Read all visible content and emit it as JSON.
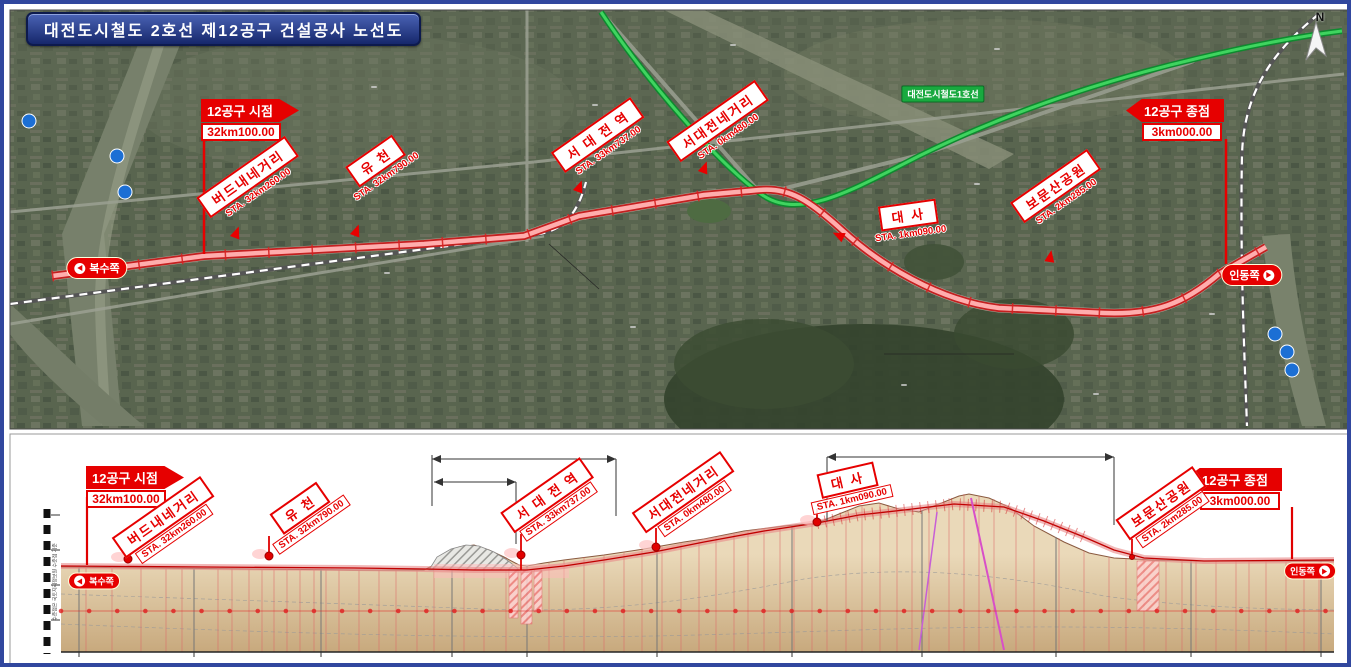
{
  "title": "대전도시철도 2호선 제12공구 건설공사 노선도",
  "flags": {
    "start": {
      "title": "12공구 시점",
      "value": "32km100.00"
    },
    "end": {
      "title": "12공구 종점",
      "value": "3km000.00"
    }
  },
  "directions": {
    "left": "복수쪽",
    "right": "인동쪽"
  },
  "map": {
    "compass": "N",
    "line1_label": "대전도시철도1호선",
    "areas": [
      {
        "label": "태 평 동",
        "x": 370,
        "y": 83
      },
      {
        "label": "오 류 동",
        "x": 591,
        "y": 101
      },
      {
        "label": "용 두 동",
        "x": 729,
        "y": 41
      },
      {
        "label": "은 행 선 화 동",
        "x": 993,
        "y": 45
      },
      {
        "label": "대 흥 동",
        "x": 973,
        "y": 180
      },
      {
        "label": "유 천 동",
        "x": 383,
        "y": 269
      },
      {
        "label": "문 화 동",
        "x": 629,
        "y": 323
      },
      {
        "label": "대 사 동",
        "x": 900,
        "y": 381
      },
      {
        "label": "부 사 동",
        "x": 1092,
        "y": 390
      },
      {
        "label": "문 창 동",
        "x": 1208,
        "y": 310
      }
    ],
    "pois": [
      {
        "label": "서대전역[KTX]",
        "x": 527,
        "y": 159
      },
      {
        "label": "유천현대아파트",
        "x": 491,
        "y": 186
      },
      {
        "label": "삼성아파트",
        "x": 652,
        "y": 151
      },
      {
        "label": "서대전네거리역",
        "x": 778,
        "y": 179
      },
      {
        "label": "서대전공원",
        "x": 717,
        "y": 200
      },
      {
        "label": "세이백화점",
        "x": 656,
        "y": 211
      },
      {
        "label": "서대전육교",
        "x": 548,
        "y": 222
      },
      {
        "label": "서대전육교 지하화 구간",
        "x": 592,
        "y": 291
      },
      {
        "label": "L=699m",
        "x": 578,
        "y": 303
      },
      {
        "label": "호남선(충청권광역철도)",
        "x": 488,
        "y": 336
      },
      {
        "label": "충남대학교",
        "x": 889,
        "y": 298
      },
      {
        "label": "병원",
        "x": 889,
        "y": 309
      },
      {
        "label": "테미고개",
        "x": 910,
        "y": 318
      },
      {
        "label": "테미고개 지하차도 구간",
        "x": 920,
        "y": 348
      },
      {
        "label": "L=1,101m",
        "x": 931,
        "y": 360
      },
      {
        "label": "수도산",
        "x": 929,
        "y": 264
      },
      {
        "label": "한화생명",
        "x": 1078,
        "y": 310
      },
      {
        "label": "이글스파크",
        "x": 1078,
        "y": 321
      },
      {
        "label": "한화생명",
        "x": 1157,
        "y": 334
      },
      {
        "label": "볼파크",
        "x": 1157,
        "y": 346
      },
      {
        "label": "대전역",
        "x": 1183,
        "y": 51
      },
      {
        "label": "대전역(경부선)",
        "x": 1255,
        "y": 66
      }
    ],
    "stations": [
      {
        "name": "버드내네거리",
        "sta": "STA. 32km260.00",
        "x": 247,
        "y": 178,
        "rot": -35
      },
      {
        "name": "유  천",
        "sta": "STA. 32km790.00",
        "x": 375,
        "y": 162,
        "rot": -35
      },
      {
        "name": "서 대 전 역",
        "sta": "STA. 33km737.00",
        "x": 597,
        "y": 136,
        "rot": -35
      },
      {
        "name": "서대전네거리",
        "sta": "STA. 0km480.00",
        "x": 717,
        "y": 122,
        "rot": -35
      },
      {
        "name": "대   사",
        "sta": "STA. 1km090.00",
        "x": 905,
        "y": 217,
        "rot": -8
      },
      {
        "name": "보문산공원",
        "sta": "STA. 2km285.00",
        "x": 1055,
        "y": 187,
        "rot": -35
      }
    ],
    "river_badges": [
      {
        "label": "유",
        "x": 25,
        "y": 117
      },
      {
        "label": "등",
        "x": 113,
        "y": 152
      },
      {
        "label": "천",
        "x": 121,
        "y": 188
      },
      {
        "label": "대",
        "x": 1271,
        "y": 330
      },
      {
        "label": "전",
        "x": 1283,
        "y": 348
      },
      {
        "label": "천",
        "x": 1288,
        "y": 366
      }
    ]
  },
  "profile": {
    "side_note": "수준점은 국토지리정보원 수준점 기준",
    "y_axis": [
      {
        "label": "180.00",
        "y": 511
      },
      {
        "label": "160.00",
        "y": 546
      },
      {
        "label": "140.00",
        "y": 581
      },
      {
        "label": "120.00",
        "y": 616
      }
    ],
    "x_ticks": [
      {
        "label": "100",
        "x": 75
      },
      {
        "label": "500",
        "x": 190
      },
      {
        "label": "33km",
        "x": 317
      },
      {
        "label": "500",
        "x": 448
      },
      {
        "label": "0km",
        "x": 523
      },
      {
        "label": "500",
        "x": 653
      },
      {
        "label": "1km",
        "x": 788
      },
      {
        "label": "500",
        "x": 918
      },
      {
        "label": "2km",
        "x": 1052
      },
      {
        "label": "500",
        "x": 1187
      },
      {
        "label": "3km",
        "x": 1317
      }
    ],
    "stations": [
      {
        "name": "버드내네거리",
        "sta": "STA. 32km260.00",
        "x": 163,
        "y": 519,
        "rot": -35
      },
      {
        "name": "유  천",
        "sta": "STA. 32km790.00",
        "x": 300,
        "y": 510,
        "rot": -35
      },
      {
        "name": "서 대 전 역",
        "sta": "STA. 33km737.00",
        "x": 547,
        "y": 497,
        "rot": -35
      },
      {
        "name": "서대전네거리",
        "sta": "STA. 0km480.00",
        "x": 683,
        "y": 494,
        "rot": -35
      },
      {
        "name": "대   사",
        "sta": "STA. 1km090.00",
        "x": 845,
        "y": 483,
        "rot": -13
      },
      {
        "name": "보문산공원",
        "sta": "STA. 2km285.00",
        "x": 1161,
        "y": 505,
        "rot": -35
      }
    ],
    "texts": [
      {
        "label": "서대전육교 지하화 구간",
        "x": 520,
        "y": 446
      },
      {
        "label": "L=699m",
        "x": 520,
        "y": 459
      },
      {
        "label": "지하차도 구간",
        "x": 468,
        "y": 472
      },
      {
        "label": "L=300m",
        "x": 464,
        "y": 486
      },
      {
        "label": "테미고개 지하차도 구간",
        "x": 966,
        "y": 446
      },
      {
        "label": "L=1,101m",
        "x": 966,
        "y": 460
      }
    ],
    "note_loop": [
      {
        "label": "순환종점 = 시점",
        "x": 575,
        "y": 539
      },
      {
        "label": "STA. 33km780.00 = 0km000.00",
        "x": 583,
        "y": 548
      }
    ],
    "small_labels": [
      {
        "label": "호남선",
        "x": 470,
        "y": 556
      },
      {
        "label": "(충청권광역철도)",
        "x": 478,
        "y": 565
      },
      {
        "label": "서대전 네거리",
        "x": 687,
        "y": 550
      },
      {
        "label": "충대병원 네거리",
        "x": 874,
        "y": 515
      },
      {
        "label": "테미고개삼거리",
        "x": 913,
        "y": 524
      },
      {
        "label": "보문산공원",
        "x": 1067,
        "y": 531
      },
      {
        "label": "오거리",
        "x": 1067,
        "y": 540
      },
      {
        "label": "충무로네거리",
        "x": 1225,
        "y": 552
      }
    ],
    "faults": [
      {
        "label": "F1",
        "x": 927,
        "y": 570
      },
      {
        "label": "F2",
        "x": 957,
        "y": 570
      }
    ],
    "grades": [
      {
        "v": "-20",
        "x": 63,
        "y": 606,
        "c": "#909090"
      },
      {
        "v": "9",
        "x": 90,
        "y": 606
      },
      {
        "v": "2",
        "x": 120,
        "y": 606
      },
      {
        "v": "1",
        "x": 160,
        "y": 606
      },
      {
        "v": "-2.5",
        "x": 190,
        "y": 606
      },
      {
        "v": "8",
        "x": 214,
        "y": 606
      },
      {
        "v": "10",
        "x": 224,
        "y": 617
      },
      {
        "v": "-5",
        "x": 237,
        "y": 597
      },
      {
        "v": "-2",
        "x": 258,
        "y": 606
      },
      {
        "v": "6",
        "x": 283,
        "y": 606
      },
      {
        "v": "3",
        "x": 296,
        "y": 606
      },
      {
        "v": "17",
        "x": 310,
        "y": 597
      },
      {
        "v": "-9",
        "x": 323,
        "y": 606
      },
      {
        "v": "-12.5",
        "x": 336,
        "y": 617
      },
      {
        "v": "2",
        "x": 355,
        "y": 606
      },
      {
        "v": "10",
        "x": 392,
        "y": 597
      },
      {
        "v": "-3",
        "x": 413,
        "y": 606
      },
      {
        "v": "-47",
        "x": 443,
        "y": 606
      },
      {
        "v": "3",
        "x": 502,
        "y": 606
      },
      {
        "v": "48",
        "x": 575,
        "y": 606
      },
      {
        "v": "3",
        "x": 620,
        "y": 606
      },
      {
        "v": "-6",
        "x": 648,
        "y": 606
      },
      {
        "v": "6",
        "x": 675,
        "y": 606
      },
      {
        "v": "31",
        "x": 695,
        "y": 595
      },
      {
        "v": "47",
        "x": 712,
        "y": 606
      },
      {
        "v": "34",
        "x": 744,
        "y": 606
      },
      {
        "v": "11",
        "x": 776,
        "y": 606
      },
      {
        "v": "23",
        "x": 808,
        "y": 606
      },
      {
        "v": "-44",
        "x": 842,
        "y": 606
      },
      {
        "v": "-25",
        "x": 876,
        "y": 606
      },
      {
        "v": "-3",
        "x": 908,
        "y": 606
      },
      {
        "v": "45",
        "x": 950,
        "y": 606
      },
      {
        "v": "-40",
        "x": 1012,
        "y": 606
      },
      {
        "v": "46",
        "x": 1080,
        "y": 606
      },
      {
        "v": "-6",
        "x": 1122,
        "y": 606
      },
      {
        "v": "-5",
        "x": 1162,
        "y": 606
      },
      {
        "v": "-12",
        "x": 1192,
        "y": 595
      },
      {
        "v": "-6",
        "x": 1212,
        "y": 606
      },
      {
        "v": "-2",
        "x": 1245,
        "y": 606
      },
      {
        "v": "-1",
        "x": 1282,
        "y": 606
      },
      {
        "v": "12",
        "x": 1308,
        "y": 606,
        "c": "#909090"
      }
    ]
  },
  "chart_data": {
    "type": "area",
    "y_tick_labels": [
      "180.00",
      "160.00",
      "140.00",
      "120.00"
    ],
    "x_tick_labels": [
      "100",
      "500",
      "33km",
      "500",
      "0km",
      "500",
      "1km",
      "500",
      "2km",
      "500",
      "3km"
    ],
    "grade_values": [
      "-20",
      "9",
      "2",
      "1",
      "-2.5",
      "8",
      "10",
      "-5",
      "-2",
      "6",
      "3",
      "17",
      "-9",
      "-12.5",
      "2",
      "10",
      "-3",
      "-47",
      "3",
      "48",
      "3",
      "-6",
      "6",
      "31",
      "47",
      "34",
      "11",
      "23",
      "-44",
      "-25",
      "-3",
      "45",
      "-40",
      "46",
      "-6",
      "-5",
      "-12",
      "-6",
      "-2",
      "-1",
      "12"
    ],
    "ylim": [
      120,
      180
    ]
  }
}
